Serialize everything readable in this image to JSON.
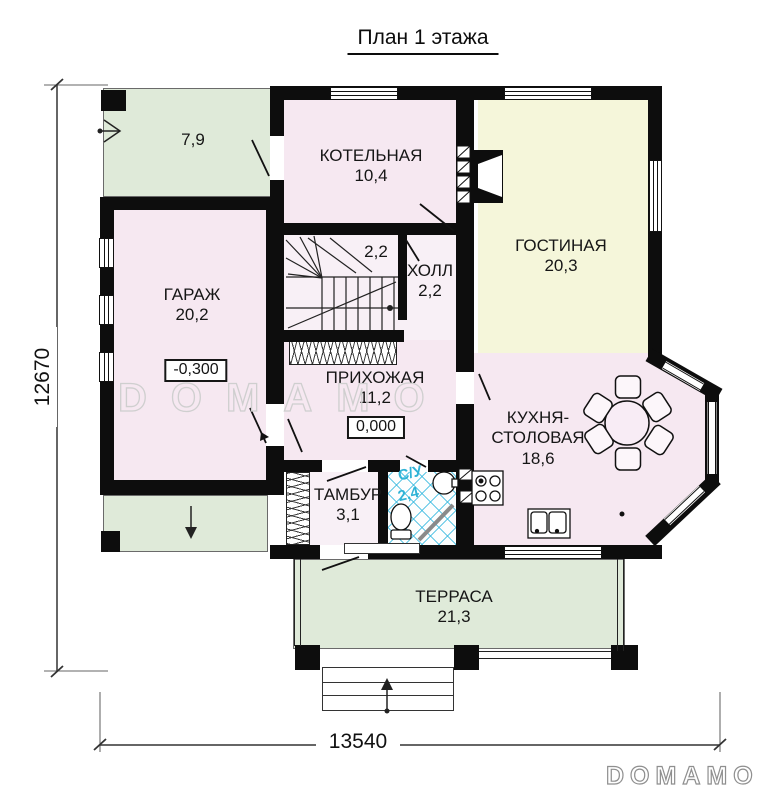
{
  "title": "План 1 этажа",
  "dimensions": {
    "height_mm": "12670",
    "width_mm": "13540"
  },
  "watermark": {
    "center": "DOMAMO",
    "logo": "DOMAMO"
  },
  "rooms": {
    "porch": {
      "area": "7,9"
    },
    "boiler": {
      "name": "КОТЕЛЬНАЯ",
      "area": "10,4"
    },
    "living": {
      "name": "ГОСТИНАЯ",
      "area": "20,3"
    },
    "garage": {
      "name": "ГАРАЖ",
      "area": "20,2",
      "elevation": "-0,300"
    },
    "stair": {
      "area": "2,2"
    },
    "hall": {
      "name": "ХОЛЛ",
      "area": "2,2"
    },
    "entry": {
      "name": "ПРИХОЖАЯ",
      "area": "11,2",
      "elevation": "0,000"
    },
    "vestibule": {
      "name": "ТАМБУР",
      "area": "3,1"
    },
    "wc": {
      "name": "С/У",
      "area": "2,4"
    },
    "kitchen": {
      "name_line1": "КУХНЯ-",
      "name_line2": "СТОЛОВАЯ",
      "area": "18,6"
    },
    "terrace": {
      "name": "ТЕРРАСА",
      "area": "21,3"
    }
  },
  "colors": {
    "wall": "#0d0d0d",
    "room_pink": "#f6e8f1",
    "room_cream": "#f5f6da",
    "outdoor_green": "#dfead9",
    "tile_blue": "#46bee1",
    "watermark_gray": "#cfcfcf"
  }
}
